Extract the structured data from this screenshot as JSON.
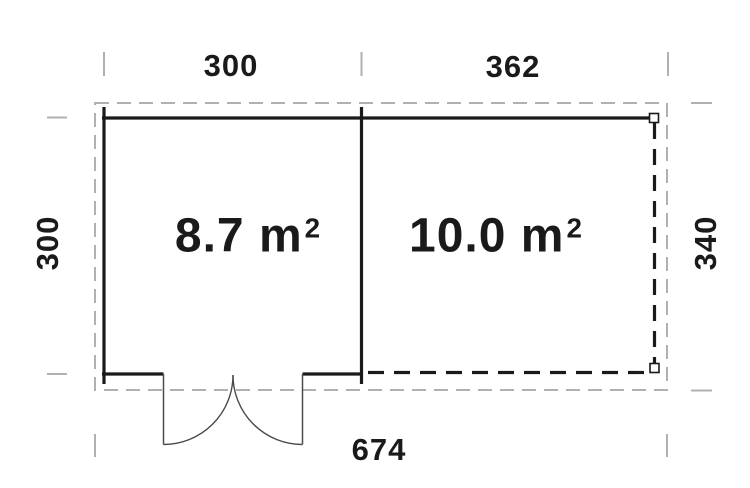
{
  "diagram": {
    "kind": "floor-plan",
    "dimensions": {
      "top_left": "300",
      "top_right": "362",
      "left": "300",
      "right": "340",
      "bottom": "674"
    },
    "rooms": [
      {
        "id": "room-left",
        "area": "8.7 m",
        "area_exponent": "2"
      },
      {
        "id": "room-right",
        "area": "10.0 m",
        "area_exponent": "2"
      }
    ],
    "colors": {
      "wall": "#1a1a1a",
      "dashed_wall": "#1a1a1a",
      "boundary_dashed": "#b0b0b0",
      "door_lines": "#4a4a4a",
      "text": "#1a1a1a",
      "background": "#ffffff"
    }
  }
}
